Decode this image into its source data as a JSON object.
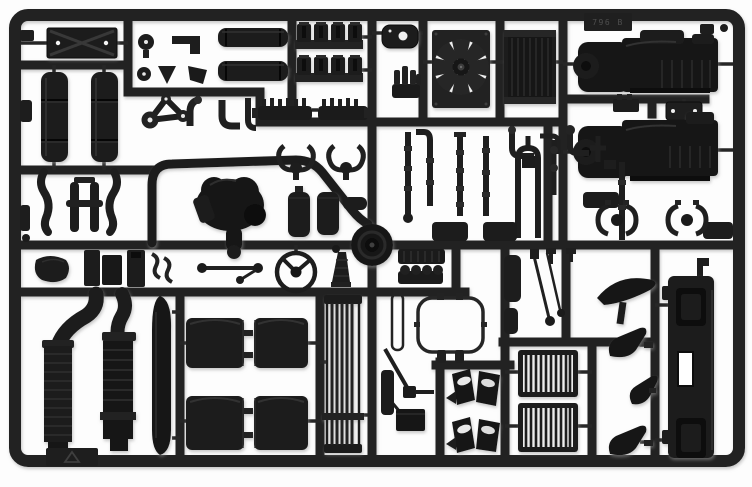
{
  "description": "Photograph of a black injection-moulded plastic model-kit sprue (parts tree) for a truck model, shot on a plain white background. Dozens of unpainted black parts hang inside a rectangular runner frame.",
  "sprue": {
    "plastic_color": "#1c1c1c",
    "runner_color": "#212121",
    "background_color": "#ffffff",
    "tag_text": "796 B",
    "material_marking": "recycling-triangle symbol embossed on a small tab",
    "layout": "rectangular outer frame with internal horizontal and vertical runner bars"
  },
  "parts_inventory": [
    {
      "name": "cab-floor-panel",
      "count": 1,
      "desc": "flat plate with X cross-ribs and two locating holes"
    },
    {
      "name": "air-tank",
      "count": 2,
      "desc": "vertical cylindrical reservoirs with band lines"
    },
    {
      "name": "v-belt-with-pulleys",
      "count": 1,
      "desc": "triangular belt run over three pulleys"
    },
    {
      "name": "pulley-and-bracket-fittings",
      "count": 6,
      "desc": "small caps, cones, wedges and brackets"
    },
    {
      "name": "elbow-pipe",
      "count": 6,
      "desc": "short L and S pipe fittings"
    },
    {
      "name": "silencer-bar",
      "count": 2,
      "desc": "horizontal rounded muffler bodies"
    },
    {
      "name": "cylinder-head-bank",
      "count": 2,
      "desc": "rows of four cylinder-head blocks on a bar"
    },
    {
      "name": "serrated-rack",
      "count": 2,
      "desc": "toothed horizontal strips"
    },
    {
      "name": "engine-cover-plate",
      "count": 1,
      "desc": "oval plate with centre hole"
    },
    {
      "name": "intake-manifold",
      "count": 1,
      "desc": "block with upright stubs"
    },
    {
      "name": "radiator-fan-with-shroud",
      "count": 1,
      "desc": "eight-blade fan in square shroud"
    },
    {
      "name": "radiator-core",
      "count": 1,
      "desc": "rectangle with vertical fins"
    },
    {
      "name": "sprue-id-tag",
      "count": 1,
      "desc": "embossed tag reading 796 B"
    },
    {
      "name": "engine-gearbox-half",
      "count": 2,
      "desc": "large engine/transmission assemblies"
    },
    {
      "name": "mounting-plate",
      "count": 1,
      "desc": "small plate with two holes"
    },
    {
      "name": "roll-bar-tube",
      "count": 1,
      "desc": "large inverted-U bent tube"
    },
    {
      "name": "engine-v8-block",
      "count": 1,
      "desc": "irregular engine casting cluster"
    },
    {
      "name": "s-bend-pipe",
      "count": 2,
      "desc": "S-curved exhaust pipes"
    },
    {
      "name": "h-bracket",
      "count": 1,
      "desc": "H-shaped frame bracket"
    },
    {
      "name": "exhaust-hanger-hooks",
      "count": 2,
      "desc": "paired C-hooks with disc"
    },
    {
      "name": "small-tank",
      "count": 2,
      "desc": "small rounded canisters"
    },
    {
      "name": "air-line-pipe",
      "count": 7,
      "desc": "vertical pipes with clamp collars"
    },
    {
      "name": "junction-block",
      "count": 4,
      "desc": "rounded rectangular blocks"
    },
    {
      "name": "spring-shackle-clamps",
      "count": 2,
      "desc": "paired C-clamps with centre disc"
    },
    {
      "name": "seat-base",
      "count": 1,
      "desc": "rounded cushion blob"
    },
    {
      "name": "panel-block",
      "count": 3,
      "desc": "small rectangular panels"
    },
    {
      "name": "track-rod",
      "count": 1,
      "desc": "rod with ball ends"
    },
    {
      "name": "steering-wheel",
      "count": 1,
      "desc": "rim with two spokes and hub"
    },
    {
      "name": "gear-lever-boot",
      "count": 1,
      "desc": "ribbed cone with knob"
    },
    {
      "name": "wheel-hub-drum",
      "count": 1,
      "desc": "large round hub on runner cross"
    },
    {
      "name": "finned-valve-cover",
      "count": 1,
      "desc": "block with cooling fins"
    },
    {
      "name": "exhaust-manifold-bumps",
      "count": 1,
      "desc": "bar with four domes"
    },
    {
      "name": "wiper-arm",
      "count": 2,
      "desc": "thin rods with pivot discs"
    },
    {
      "name": "sun-visor-blade",
      "count": 1,
      "desc": "curved crescent blade"
    },
    {
      "name": "door-panel-strip",
      "count": 2,
      "desc": "small rounded strips"
    },
    {
      "name": "exhaust-downpipe",
      "count": 2,
      "desc": "ribbed vertical exhaust stacks with elbows"
    },
    {
      "name": "side-skirt-blade",
      "count": 1,
      "desc": "long lens-shaped vertical blade"
    },
    {
      "name": "material-tab",
      "count": 1,
      "desc": "tab with recycling triangle"
    },
    {
      "name": "mudguard",
      "count": 4,
      "desc": "large rounded fender shells with hinge tabs"
    },
    {
      "name": "grille-ladder",
      "count": 1,
      "desc": "tall slatted grille strip"
    },
    {
      "name": "window-seal-frame",
      "count": 1,
      "desc": "thin rounded gasket frame"
    },
    {
      "name": "gear-linkage",
      "count": 1,
      "desc": "diagonal rod with pad"
    },
    {
      "name": "battery-box",
      "count": 1,
      "desc": "dark rectangular box"
    },
    {
      "name": "mudflap-set",
      "count": 2,
      "desc": "paired angled flaps with bright face"
    },
    {
      "name": "louvered-step-grille",
      "count": 2,
      "desc": "framed grilles with vertical slats"
    },
    {
      "name": "air-horn",
      "count": 3,
      "desc": "trumpet-shaped horns"
    },
    {
      "name": "front-bumper",
      "count": 1,
      "desc": "tall bumper with recesses and cut-out"
    }
  ]
}
